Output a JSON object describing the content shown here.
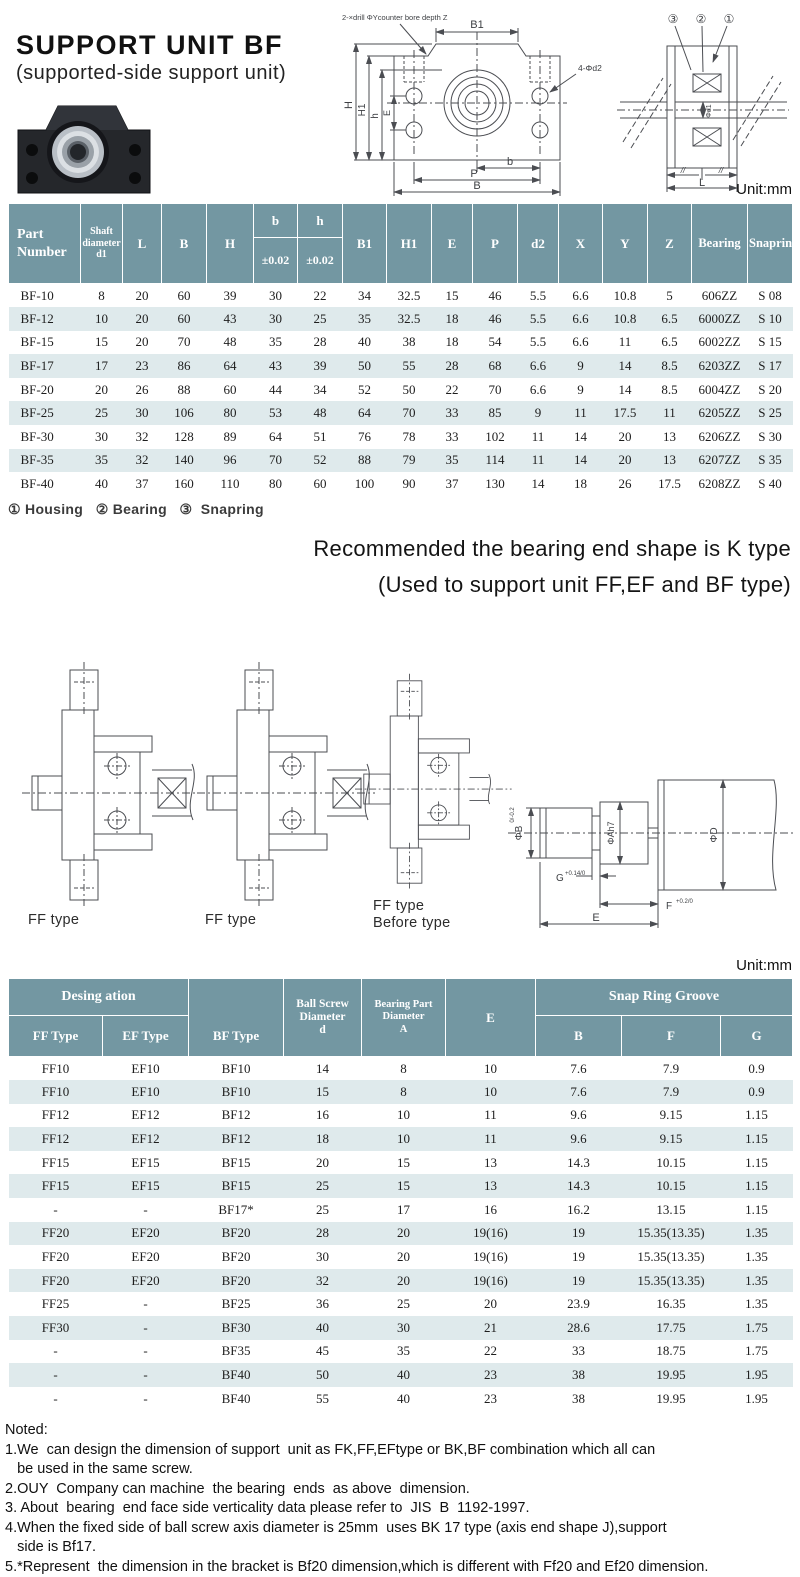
{
  "header": {
    "title": "SUPPORT  UNIT BF",
    "subtitle": "(supported-side support  unit)"
  },
  "front_drawing": {
    "drill_note": "2-×drill  ΦYcounter bore depth Z",
    "hole_note": "4-Φd2",
    "dim_b1": "B1",
    "dim_h": "H",
    "dim_h1": "H1",
    "dim_h_small": "h",
    "dim_e": "E",
    "dim_b_small": "b",
    "dim_p": "P",
    "dim_b": "B"
  },
  "side_drawing": {
    "callout_3": "③",
    "callout_2": "②",
    "callout_1": "①",
    "dim_d1": "Φd1",
    "hatch_left": "//",
    "hatch_right": "//",
    "dim_l": "L"
  },
  "table1": {
    "unit": "Unit:mm",
    "header": {
      "part_number": "Part\nNumber",
      "shaft": "Shaft\ndiameter\nd1",
      "l": "L",
      "b_col": "B",
      "h_col": "H",
      "b_small": "b",
      "h_small": "h",
      "tol": "±0.02",
      "b1": "B1",
      "h1": "H1",
      "e": "E",
      "p": "P",
      "d2": "d2",
      "x": "X",
      "y": "Y",
      "z": "Z",
      "bearing": "Bearing",
      "snapring": "Snapring"
    },
    "rows": [
      [
        "BF-10",
        "8",
        "20",
        "60",
        "39",
        "30",
        "22",
        "34",
        "32.5",
        "15",
        "46",
        "5.5",
        "6.6",
        "10.8",
        "5",
        "606ZZ",
        "S 08"
      ],
      [
        "BF-12",
        "10",
        "20",
        "60",
        "43",
        "30",
        "25",
        "35",
        "32.5",
        "18",
        "46",
        "5.5",
        "6.6",
        "10.8",
        "6.5",
        "6000ZZ",
        "S 10"
      ],
      [
        "BF-15",
        "15",
        "20",
        "70",
        "48",
        "35",
        "28",
        "40",
        "38",
        "18",
        "54",
        "5.5",
        "6.6",
        "11",
        "6.5",
        "6002ZZ",
        "S 15"
      ],
      [
        "BF-17",
        "17",
        "23",
        "86",
        "64",
        "43",
        "39",
        "50",
        "55",
        "28",
        "68",
        "6.6",
        "9",
        "14",
        "8.5",
        "6203ZZ",
        "S 17"
      ],
      [
        "BF-20",
        "20",
        "26",
        "88",
        "60",
        "44",
        "34",
        "52",
        "50",
        "22",
        "70",
        "6.6",
        "9",
        "14",
        "8.5",
        "6004ZZ",
        "S 20"
      ],
      [
        "BF-25",
        "25",
        "30",
        "106",
        "80",
        "53",
        "48",
        "64",
        "70",
        "33",
        "85",
        "9",
        "11",
        "17.5",
        "11",
        "6205ZZ",
        "S 25"
      ],
      [
        "BF-30",
        "30",
        "32",
        "128",
        "89",
        "64",
        "51",
        "76",
        "78",
        "33",
        "102",
        "11",
        "14",
        "20",
        "13",
        "6206ZZ",
        "S 30"
      ],
      [
        "BF-35",
        "35",
        "32",
        "140",
        "96",
        "70",
        "52",
        "88",
        "79",
        "35",
        "114",
        "11",
        "14",
        "20",
        "13",
        "6207ZZ",
        "S 35"
      ],
      [
        "BF-40",
        "40",
        "37",
        "160",
        "110",
        "80",
        "60",
        "100",
        "90",
        "37",
        "130",
        "14",
        "18",
        "26",
        "17.5",
        "6208ZZ",
        "S 40"
      ]
    ],
    "footnote": "① Housing   ② Bearing   ③  Snapring"
  },
  "recommendation": {
    "line1": "Recommended  the bearing  end shape is K type",
    "line2": "(Used to support unit  FF,EF and BF type)"
  },
  "middle_drawings": {
    "ff1_label": "FF type",
    "ff2_label": "FF type",
    "ff3_label_line1": "FF type",
    "ff3_label_line2": "Before type",
    "shaft_detail": {
      "b_label": "ΦB",
      "b_tol": "0/-0.2",
      "a_label": "ΦAh7",
      "d_label": "ΦD",
      "g_label": "G",
      "g_tol": "+0.14/0",
      "f_label": "F",
      "f_tol": "+0.2/0",
      "e_label": "E"
    }
  },
  "table2": {
    "unit": "Unit:mm",
    "header": {
      "designation": "Desing ation",
      "ff_type": "FF Type",
      "ef_type": "EF Type",
      "bf_type": "BF Type",
      "ball_screw": "Ball Screw\nDiameter\nd",
      "bearing_part": "Bearing Part\nDiameter\nA",
      "e": "E",
      "snap_ring": "Snap Ring Groove",
      "b": "B",
      "f": "F",
      "g": "G"
    },
    "rows": [
      [
        "FF10",
        "EF10",
        "BF10",
        "14",
        "8",
        "10",
        "7.6",
        "7.9",
        "0.9"
      ],
      [
        "FF10",
        "EF10",
        "BF10",
        "15",
        "8",
        "10",
        "7.6",
        "7.9",
        "0.9"
      ],
      [
        "FF12",
        "EF12",
        "BF12",
        "16",
        "10",
        "11",
        "9.6",
        "9.15",
        "1.15"
      ],
      [
        "FF12",
        "EF12",
        "BF12",
        "18",
        "10",
        "11",
        "9.6",
        "9.15",
        "1.15"
      ],
      [
        "FF15",
        "EF15",
        "BF15",
        "20",
        "15",
        "13",
        "14.3",
        "10.15",
        "1.15"
      ],
      [
        "FF15",
        "EF15",
        "BF15",
        "25",
        "15",
        "13",
        "14.3",
        "10.15",
        "1.15"
      ],
      [
        "-",
        "-",
        "BF17*",
        "25",
        "17",
        "16",
        "16.2",
        "13.15",
        "1.15"
      ],
      [
        "FF20",
        "EF20",
        "BF20",
        "28",
        "20",
        "19(16)",
        "19",
        "15.35(13.35)",
        "1.35"
      ],
      [
        "FF20",
        "EF20",
        "BF20",
        "30",
        "20",
        "19(16)",
        "19",
        "15.35(13.35)",
        "1.35"
      ],
      [
        "FF20",
        "EF20",
        "BF20",
        "32",
        "20",
        "19(16)",
        "19",
        "15.35(13.35)",
        "1.35"
      ],
      [
        "FF25",
        "-",
        "BF25",
        "36",
        "25",
        "20",
        "23.9",
        "16.35",
        "1.35"
      ],
      [
        "FF30",
        "-",
        "BF30",
        "40",
        "30",
        "21",
        "28.6",
        "17.75",
        "1.75"
      ],
      [
        "-",
        "-",
        "BF35",
        "45",
        "35",
        "22",
        "33",
        "18.75",
        "1.75"
      ],
      [
        "-",
        "-",
        "BF40",
        "50",
        "40",
        "23",
        "38",
        "19.95",
        "1.95"
      ],
      [
        "-",
        "-",
        "BF40",
        "55",
        "40",
        "23",
        "38",
        "19.95",
        "1.95"
      ]
    ]
  },
  "notes": {
    "title": "Noted:",
    "lines": [
      "1.We  can design the dimension of support  unit as FK,FF,EFtype or BK,BF combination which all can",
      "   be used in the same screw.",
      "2.OUY  Company can machine  the bearing  ends  as above  dimension.",
      "3. About  bearing  end face side verticality data please refer to  JIS  B  1192-1997.",
      "4.When the fixed side of ball screw axis diameter is 25mm  uses BK 17 type (axis end shape J),support",
      "   side is Bf17.",
      "5.*Represent  the dimension in the bracket is Bf20 dimension,which is different with Ff20 and Ef20 dimension.",
      "    Please inform support unit model No.when you put order."
    ]
  }
}
